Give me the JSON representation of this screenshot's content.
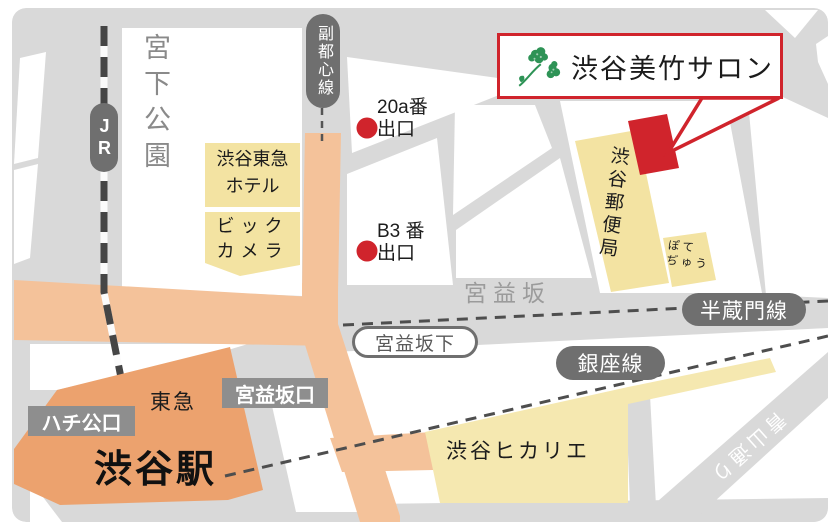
{
  "callout": {
    "title": "渋谷美竹サロン"
  },
  "labels": {
    "park": "宮下公園",
    "jr": "JR",
    "fukutoshin_line": "副都心線",
    "exit20a": {
      "line1": "20a番",
      "line2": "出口"
    },
    "exitB3": {
      "line1": "B3 番",
      "line2": "出口"
    },
    "hotel": {
      "line1": "渋谷東急",
      "line2": "ホテル"
    },
    "bic": {
      "line1": "ビック",
      "line2": "カメラ"
    },
    "postoffice": "渋谷郵便局",
    "pote": {
      "line1": "ぽて",
      "line2": "ぢゅう"
    },
    "miyamasuzaka": "宮益坂",
    "hanzomon_line": "半蔵門線",
    "miyamasuzakashita": "宮益坂下",
    "ginza_line": "銀座線",
    "tokyu": "東急",
    "miyamasuzaka_exit": "宮益坂口",
    "hachiko_exit": "ハチ公口",
    "station": "渋谷駅",
    "hikarie": "渋谷ヒカリエ",
    "aoyama_dori": "青山通り"
  },
  "colors": {
    "accent_red": "#D0242C",
    "road_orange": "#F4C29A",
    "station_orange": "#ECA26E",
    "building_yellow": "#F3E3A2",
    "hikarie_yellow": "#F5E8B0",
    "pill_gray": "#6F6F6F",
    "label_gray": "#8E8E8E",
    "base_gray": "#D9D9D9",
    "block_white": "#FFFFFF",
    "dash_gray": "#4E4E4E",
    "rail_dark": "#454545",
    "icon_green": "#2E9356"
  }
}
